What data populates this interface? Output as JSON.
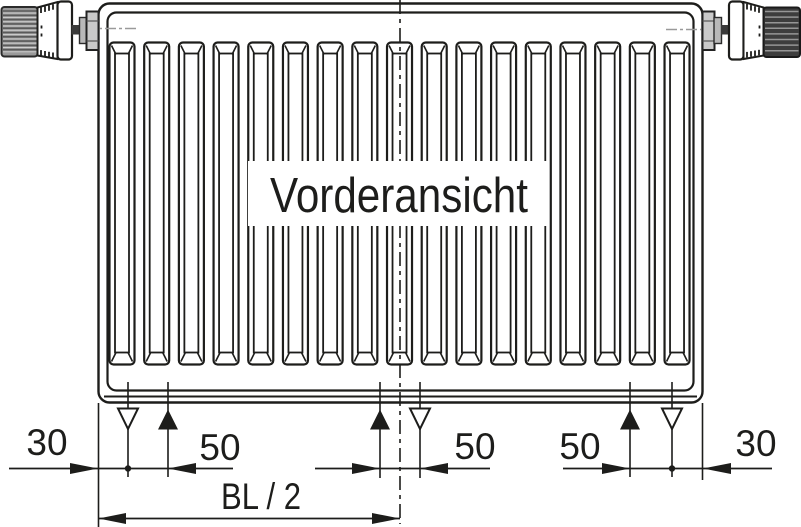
{
  "diagram": {
    "type": "technical-drawing",
    "title": "Vorderansicht",
    "line_color": "#1d1d1b",
    "gray_color": "#9a9a9a",
    "radiator": {
      "rib_count": 17
    },
    "valves": {
      "left_knob_stripe_count": 10,
      "right_knob_stripe_count": 8
    },
    "symbols": {
      "supply_symbol": "filled-triangle-up-icon",
      "return_symbol": "hollow-triangle-down-icon",
      "center_line_style": "dash-dot"
    },
    "dimension_labels": {
      "left_margin": "30",
      "left_pipe_spacing": "50",
      "center_pipe_spacing": "50",
      "right_pipe_spacing": "50",
      "right_margin": "30",
      "half_build_length": "BL / 2"
    }
  }
}
